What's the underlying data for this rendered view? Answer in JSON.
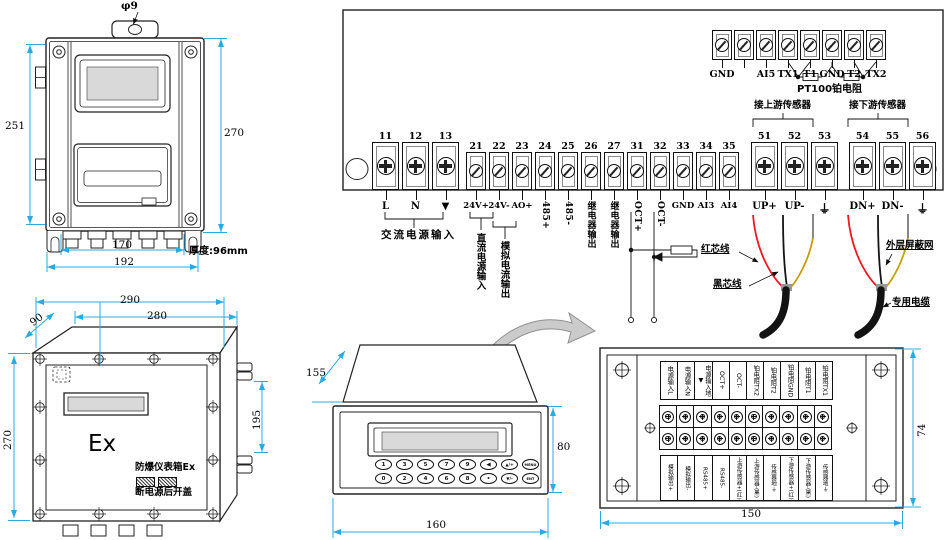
{
  "colors": {
    "dimension": "#29abe2",
    "line": "#1a1a1a",
    "red_wire": "#ed1c24",
    "yellow_wire": "#c3a006",
    "black_cable": "#131313",
    "lcd_screen": "#d9d9d9",
    "arrow_gray": "#cbcbcb"
  },
  "front_view": {
    "hole_dia_label": "φ9",
    "dim_left": "251",
    "dim_right": "270",
    "dim_bottom_inner": "170",
    "dim_bottom_outer": "192",
    "thickness_label": "厚度:96mm"
  },
  "ex_box": {
    "dim_top_outer": "290",
    "dim_top_inner": "280",
    "dim_depth": "90",
    "dim_left": "270",
    "dim_right": "195",
    "marking": "Ex",
    "label_line1": "防爆仪表箱Ex",
    "label_line2": "断电源后开盖"
  },
  "wiring": {
    "top_terminals": [
      {
        "label": "GND"
      },
      {
        "label": ""
      },
      {
        "label": "AI5"
      },
      {
        "label": "TX1"
      },
      {
        "label": "T1"
      },
      {
        "label": "GND"
      },
      {
        "label": "T2"
      },
      {
        "label": "TX2"
      }
    ],
    "pt100_label": "PT100铂电阻",
    "upstream_label": "接上游传感器",
    "downstream_label": "接下游传感器",
    "main_terminals": [
      {
        "num": "11",
        "label": "L",
        "size": "big",
        "dir": "h"
      },
      {
        "num": "12",
        "label": "N",
        "size": "big",
        "dir": "h"
      },
      {
        "num": "13",
        "label": "▼",
        "size": "big",
        "dir": "h"
      },
      {
        "num": "21",
        "label": "24V+",
        "size": "small",
        "dir": "h",
        "gap": "g4"
      },
      {
        "num": "22",
        "label": "24V-",
        "size": "small",
        "dir": "h"
      },
      {
        "num": "23",
        "label": "AO+",
        "size": "small",
        "dir": "h"
      },
      {
        "num": "24",
        "label": "485+",
        "size": "small",
        "dir": "v"
      },
      {
        "num": "25",
        "label": "485-",
        "size": "small",
        "dir": "v"
      },
      {
        "num": "26",
        "label": "继电器输出",
        "size": "small",
        "dir": "v"
      },
      {
        "num": "27",
        "label": "继电器输出",
        "size": "small",
        "dir": "v"
      },
      {
        "num": "31",
        "label": "OCT+",
        "size": "small",
        "dir": "v"
      },
      {
        "num": "32",
        "label": "OCT-",
        "size": "small",
        "dir": "v"
      },
      {
        "num": "33",
        "label": "GND",
        "size": "small",
        "dir": "h"
      },
      {
        "num": "34",
        "label": "AI3",
        "size": "small",
        "dir": "h"
      },
      {
        "num": "35",
        "label": "AI4",
        "size": "small",
        "dir": "h"
      },
      {
        "num": "51",
        "label": "UP+",
        "size": "big",
        "dir": "h",
        "gap": "g9"
      },
      {
        "num": "52",
        "label": "UP-",
        "size": "big",
        "dir": "h"
      },
      {
        "num": "53",
        "label": "⏚",
        "size": "big",
        "dir": "h",
        "sym": "gnd"
      },
      {
        "num": "54",
        "label": "DN+",
        "size": "big",
        "dir": "h",
        "gap": "g8"
      },
      {
        "num": "55",
        "label": "DN-",
        "size": "big",
        "dir": "h"
      },
      {
        "num": "56",
        "label": "⏚",
        "size": "big",
        "dir": "h",
        "sym": "gnd"
      }
    ],
    "group_labels": {
      "ac_power": "交流电源输入",
      "dc_power": "直流电源输入",
      "analog_out": "模拟电流输出"
    },
    "wire_labels": {
      "red_core": "红芯线",
      "black_core": "黑芯线",
      "shield": "外层屏蔽网",
      "cable": "专用电缆"
    }
  },
  "panel_meter": {
    "dim_depth": "155",
    "dim_height": "80",
    "dim_width": "160",
    "keys_row1": [
      "1",
      "3",
      "5",
      "7",
      "9",
      "◀",
      "▲/+",
      "MENU"
    ],
    "keys_row2": [
      "0",
      "2",
      "4",
      "6",
      "8",
      "•",
      "▼/-",
      "ENT"
    ]
  },
  "rear_view": {
    "dim_height": "74",
    "dim_width": "150",
    "top_labels": [
      "电源输入L",
      "电源输入N",
      "电源输入地▼",
      "OCT+",
      "OCT-",
      "铂电阻TX2",
      "铂电阻T2",
      "铂电阻GND",
      "铂电阻T1",
      "铂电阻TX1"
    ],
    "bottom_labels": [
      "模拟输出+",
      "模拟输出-",
      "RS485+",
      "RS485-",
      "上游传感器+(红)",
      "上游传感器-(黑)",
      "传感器地⏚",
      "下游传感器+(红)",
      "下游传感器-(黑)",
      "传感器地⏚"
    ]
  }
}
